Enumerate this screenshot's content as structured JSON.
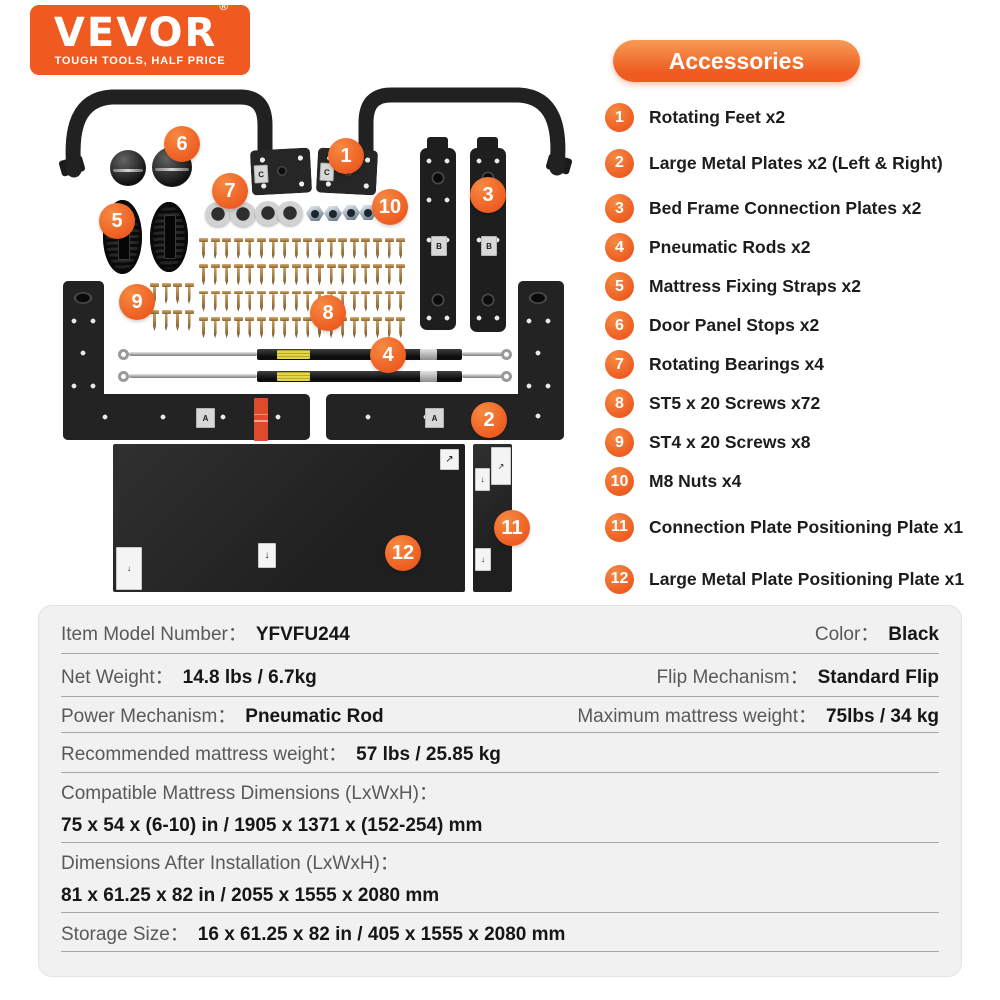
{
  "logo": {
    "brand": "VEVOR",
    "registered": "®",
    "tagline": "TOUGH TOOLS, HALF PRICE"
  },
  "accessories": {
    "title": "Accessories",
    "items": [
      {
        "num": "1",
        "label": "Rotating Feet x2"
      },
      {
        "num": "2",
        "label": "Large Metal Plates x2 (Left & Right)"
      },
      {
        "num": "3",
        "label": "Bed Frame Connection Plates x2"
      },
      {
        "num": "4",
        "label": "Pneumatic Rods x2"
      },
      {
        "num": "5",
        "label": "Mattress Fixing Straps x2"
      },
      {
        "num": "6",
        "label": "Door Panel Stops x2"
      },
      {
        "num": "7",
        "label": "Rotating Bearings x4"
      },
      {
        "num": "8",
        "label": "ST5 x 20 Screws x72"
      },
      {
        "num": "9",
        "label": "ST4 x 20 Screws x8"
      },
      {
        "num": "10",
        "label": "M8 Nuts x4"
      },
      {
        "num": "11",
        "label": "Connection Plate Positioning Plate x1"
      },
      {
        "num": "12",
        "label": "Large Metal Plate Positioning Plate x1"
      }
    ]
  },
  "diagram": {
    "stickers": {
      "bracket": "C",
      "long_plate": "B",
      "large_plate": "A"
    },
    "label_arrows": {
      "up_right": "↗",
      "down": "↓"
    }
  },
  "specs": {
    "colon": "：",
    "rows": [
      {
        "type": "pair",
        "cells": [
          {
            "label": "Item Model Number",
            "value": "YFVFU244"
          },
          {
            "label": "Color",
            "value": "Black"
          }
        ]
      },
      {
        "type": "pair",
        "cells": [
          {
            "label": "Net Weight",
            "value": "14.8 lbs / 6.7kg"
          },
          {
            "label": "Flip Mechanism",
            "value": "Standard Flip"
          }
        ]
      },
      {
        "type": "pair",
        "cells": [
          {
            "label": "Power Mechanism",
            "value": "Pneumatic Rod"
          },
          {
            "label": "Maximum mattress weight",
            "value": "75lbs / 34 kg"
          }
        ]
      },
      {
        "type": "single",
        "cells": [
          {
            "label": "Recommended mattress weight",
            "value": "57 lbs / 25.85 kg"
          }
        ]
      },
      {
        "type": "stacked",
        "cells": [
          {
            "label": "Compatible Mattress Dimensions (LxWxH)",
            "value": "75 x 54 x (6-10) in / 1905 x 1371 x (152-254) mm"
          }
        ]
      },
      {
        "type": "stacked",
        "cells": [
          {
            "label": "Dimensions After Installation (LxWxH)",
            "value": "81 x 61.25 x 82 in / 2055 x 1555 x 2080 mm"
          }
        ]
      },
      {
        "type": "single",
        "cells": [
          {
            "label": "Storage Size",
            "value": "16 x 61.25 x 82 in / 405 x 1555 x 2080 mm"
          }
        ]
      }
    ]
  },
  "hardware": {
    "large_screws": {
      "rows": 4,
      "per_row": 18
    },
    "small_screws": {
      "rows": 2,
      "per_row": 4
    }
  },
  "colors": {
    "accent": "#ee5a1f",
    "part_black": "#222222",
    "screw_gold": "#c79c5e",
    "table_bg": "#f1f1f2",
    "divider": "#a8a8a8",
    "label_gray": "#58595b"
  }
}
